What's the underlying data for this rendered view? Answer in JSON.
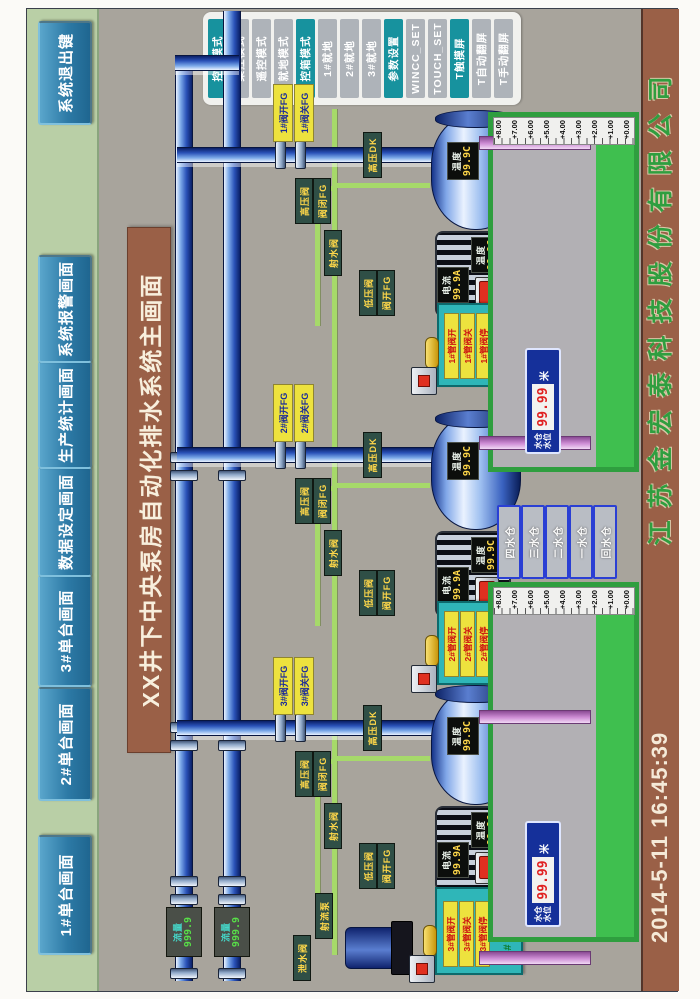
{
  "screen": {
    "title": "XX井下中央泵房自动化排水系统主画面"
  },
  "nav": {
    "items": [
      {
        "label": "1#单台画面"
      },
      {
        "label": "2#单台画面"
      },
      {
        "label": "3#单台画面"
      },
      {
        "label": "数据设定画面"
      },
      {
        "label": "生产统计画面"
      },
      {
        "label": "系统报警画面"
      }
    ],
    "exit_label": "系统退出键"
  },
  "side_panel": {
    "buttons": [
      {
        "label": "控柜模式"
      },
      {
        "label": "集控模式"
      },
      {
        "label": "遥控模式"
      },
      {
        "label": "就地模式"
      },
      {
        "label": "控箱模式"
      },
      {
        "label": "1#就地"
      },
      {
        "label": "2#就地"
      },
      {
        "label": "3#就地"
      },
      {
        "label": "参数设置"
      },
      {
        "label": "WINCC_SET"
      },
      {
        "label": "TOUCH_SET"
      },
      {
        "label": "T触摸屏"
      },
      {
        "label": "T自动翻屏"
      },
      {
        "label": "T手动翻屏"
      }
    ]
  },
  "footer": {
    "date_time": "2014-5-11  16:45:39",
    "company": "江苏金宏泰科技股份有限公司"
  },
  "flow_meters": [
    {
      "label": "流量",
      "value": "999.9"
    },
    {
      "label": "流量",
      "value": "999.9"
    }
  ],
  "pumps": [
    {
      "id": "3#",
      "valve_open_fb": "3#阀开FG",
      "valve_close_fb": "3#阀关FG",
      "pipe_tag": "高压DK",
      "hp_valve": "高压阀",
      "hp_valve_fb": "阀闭FG",
      "lp_valve": "低压阀",
      "lp_valve_fb": "阀开FG",
      "jet_valve": "射水阀",
      "barrel_temp_label": "温度",
      "barrel_temp_value": "99.9C",
      "motor_current_label": "电流",
      "motor_current_value": "99.9A",
      "motor_temp_label": "温度",
      "motor_temp_value": "99.9C",
      "station": {
        "title": "3#液压站",
        "open": "3#管阀开",
        "close": "3#管阀关",
        "stop": "3#管阀停"
      }
    },
    {
      "id": "2#",
      "valve_open_fb": "2#阀开FG",
      "valve_close_fb": "2#阀关FG",
      "pipe_tag": "高压DK",
      "hp_valve": "高压阀",
      "hp_valve_fb": "阀闭FG",
      "lp_valve": "低压阀",
      "lp_valve_fb": "阀开FG",
      "jet_valve": "射水阀",
      "barrel_temp_label": "温度",
      "barrel_temp_value": "99.9C",
      "motor_current_label": "电流",
      "motor_current_value": "99.9A",
      "motor_temp_label": "温度",
      "motor_temp_value": "99.9C",
      "station": {
        "title": "2#液压站",
        "open": "2#管阀开",
        "close": "2#管阀关",
        "stop": "2#管阀停"
      }
    },
    {
      "id": "1#",
      "valve_open_fb": "1#阀开FG",
      "valve_close_fb": "1#阀关FG",
      "pipe_tag": "高压DK",
      "hp_valve": "高压阀",
      "hp_valve_fb": "阀闭FG",
      "lp_valve": "低压阀",
      "lp_valve_fb": "阀开FG",
      "jet_valve": "射水阀",
      "barrel_temp_label": "温度",
      "barrel_temp_value": "99.9C",
      "motor_current_label": "电流",
      "motor_current_value": "99.9A",
      "motor_temp_label": "温度",
      "motor_temp_value": "99.9C",
      "station": {
        "title": "1#液压站",
        "open": "1#管阀开",
        "close": "1#管阀关",
        "stop": "1#管阀停"
      }
    }
  ],
  "jet_pump": {
    "pump_tag": "射流泵",
    "drain_tag": "泄水阀"
  },
  "sumps": {
    "scale": [
      "+8.00",
      "+7.00",
      "+6.00",
      "+5.00",
      "+4.00",
      "+3.00",
      "+2.00",
      "+1.00",
      "+0.00"
    ],
    "left_display": {
      "line1": "水仓",
      "line2": "水位",
      "value": "99.99",
      "unit": "米"
    },
    "right_display": {
      "line1": "水仓",
      "line2": "水位",
      "value": "99.99",
      "unit": "米"
    },
    "selector_buttons": [
      "四水仓",
      "三水仓",
      "二水仓",
      "一水仓",
      "回水仓"
    ]
  },
  "colors": {
    "accent_teal": "#17929e",
    "bar_brown": "#9a6047",
    "sump_green": "#2f9e3f",
    "pipe_blue": "#2a52b8",
    "suction_magenta": "#cf8fd6"
  }
}
